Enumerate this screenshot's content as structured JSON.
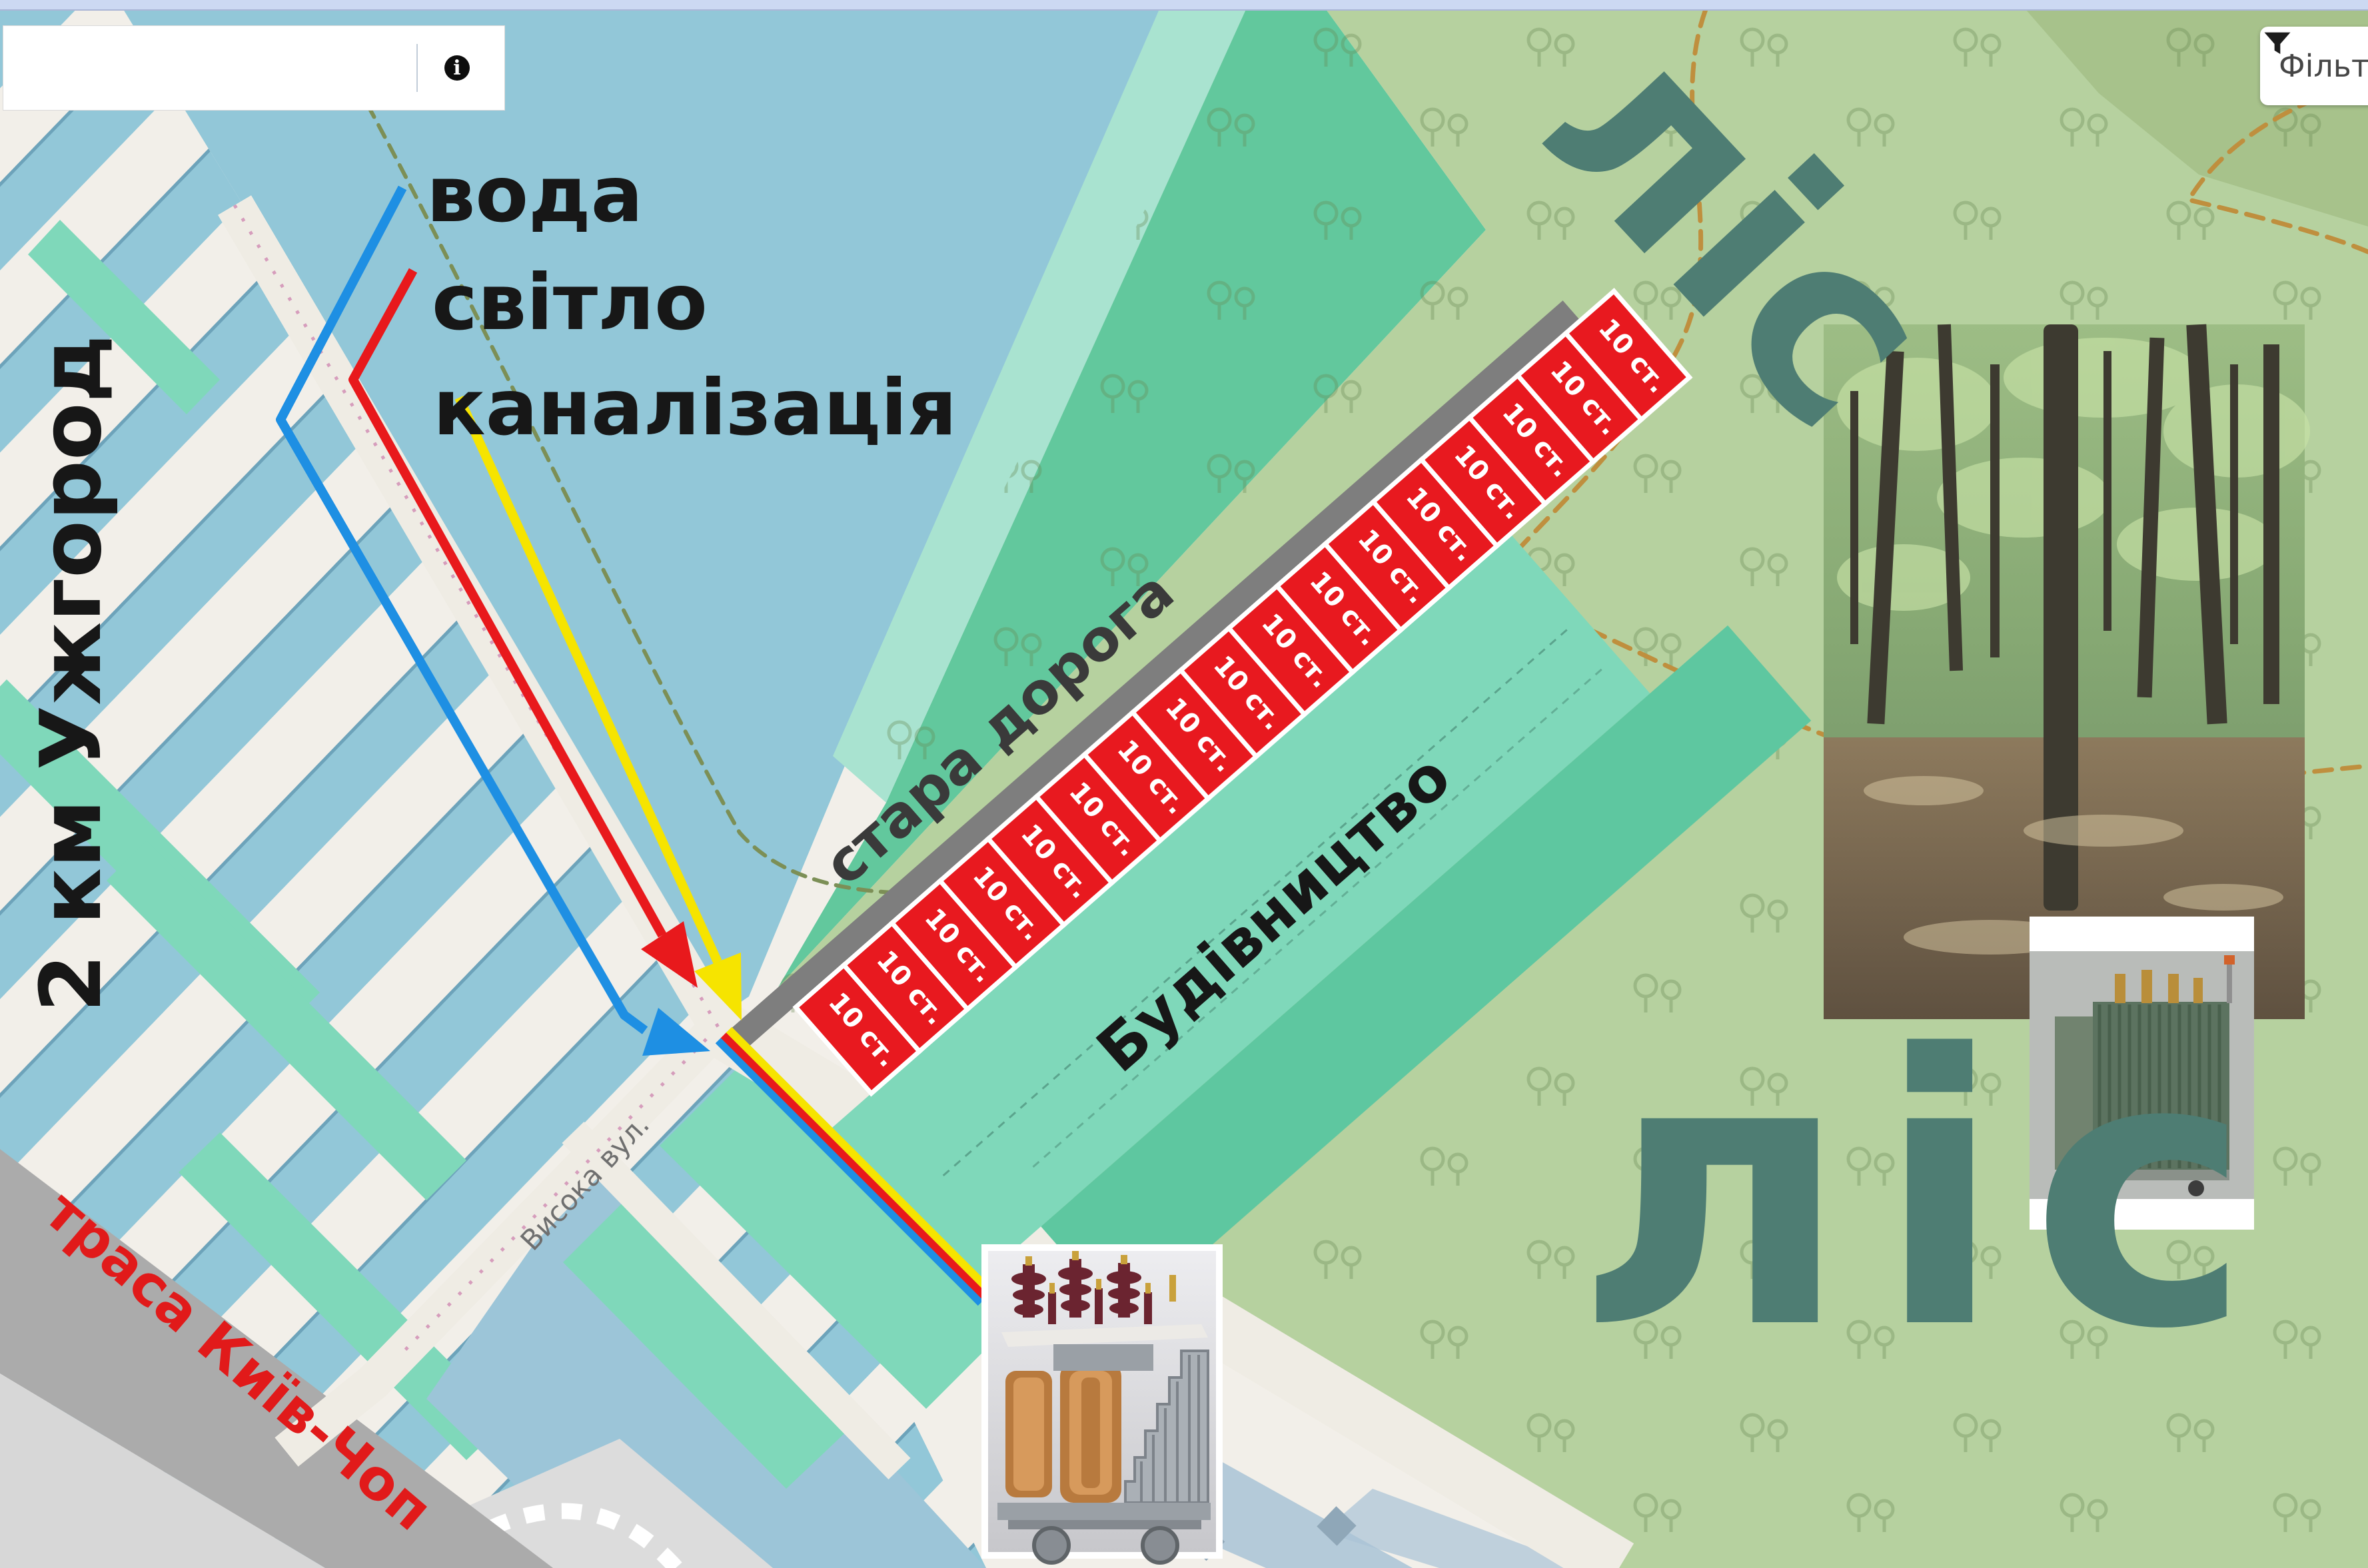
{
  "search": {
    "value": "",
    "placeholder": "",
    "info_glyph": "i",
    "icon": "info-icon"
  },
  "filter": {
    "label": "Фільтр",
    "icon": "filter-funnel-icon"
  },
  "legend": {
    "items": [
      {
        "id": "water",
        "label": "вода",
        "color": "#1e8fe3"
      },
      {
        "id": "electricity",
        "label": "світло",
        "color": "#e8191c"
      },
      {
        "id": "sewerage",
        "label": "каналізація",
        "color": "#f6e400"
      }
    ]
  },
  "map": {
    "labels": {
      "distance": "2 км Ужгород",
      "old_road": "стара дорога",
      "construction": "Будівництво",
      "forest_top": "ліс",
      "forest_bottom": "ліс",
      "highway": "траса Київ-Чоп",
      "street": "Висока вул."
    },
    "parcels": {
      "label": "10 ст.",
      "count": 17,
      "fill": "#e8191f"
    },
    "colors": {
      "field_blue": "#92c7d8",
      "cream": "#f2efe9",
      "teal": "#7fd8ba",
      "teal_dark": "#5ec7a0",
      "green_medium": "#62c89d",
      "green_pale": "#a9e3d0",
      "forest_green": "#b6d19f",
      "road_gray": "#7e7e7e",
      "highway_gray": "#ababab",
      "forest_text": "#4e7d73",
      "highway_text": "#e11a1a"
    },
    "photos": [
      {
        "id": "forest-photo"
      },
      {
        "id": "transformer-photo-right"
      },
      {
        "id": "transformer-photo-bottom"
      }
    ]
  }
}
